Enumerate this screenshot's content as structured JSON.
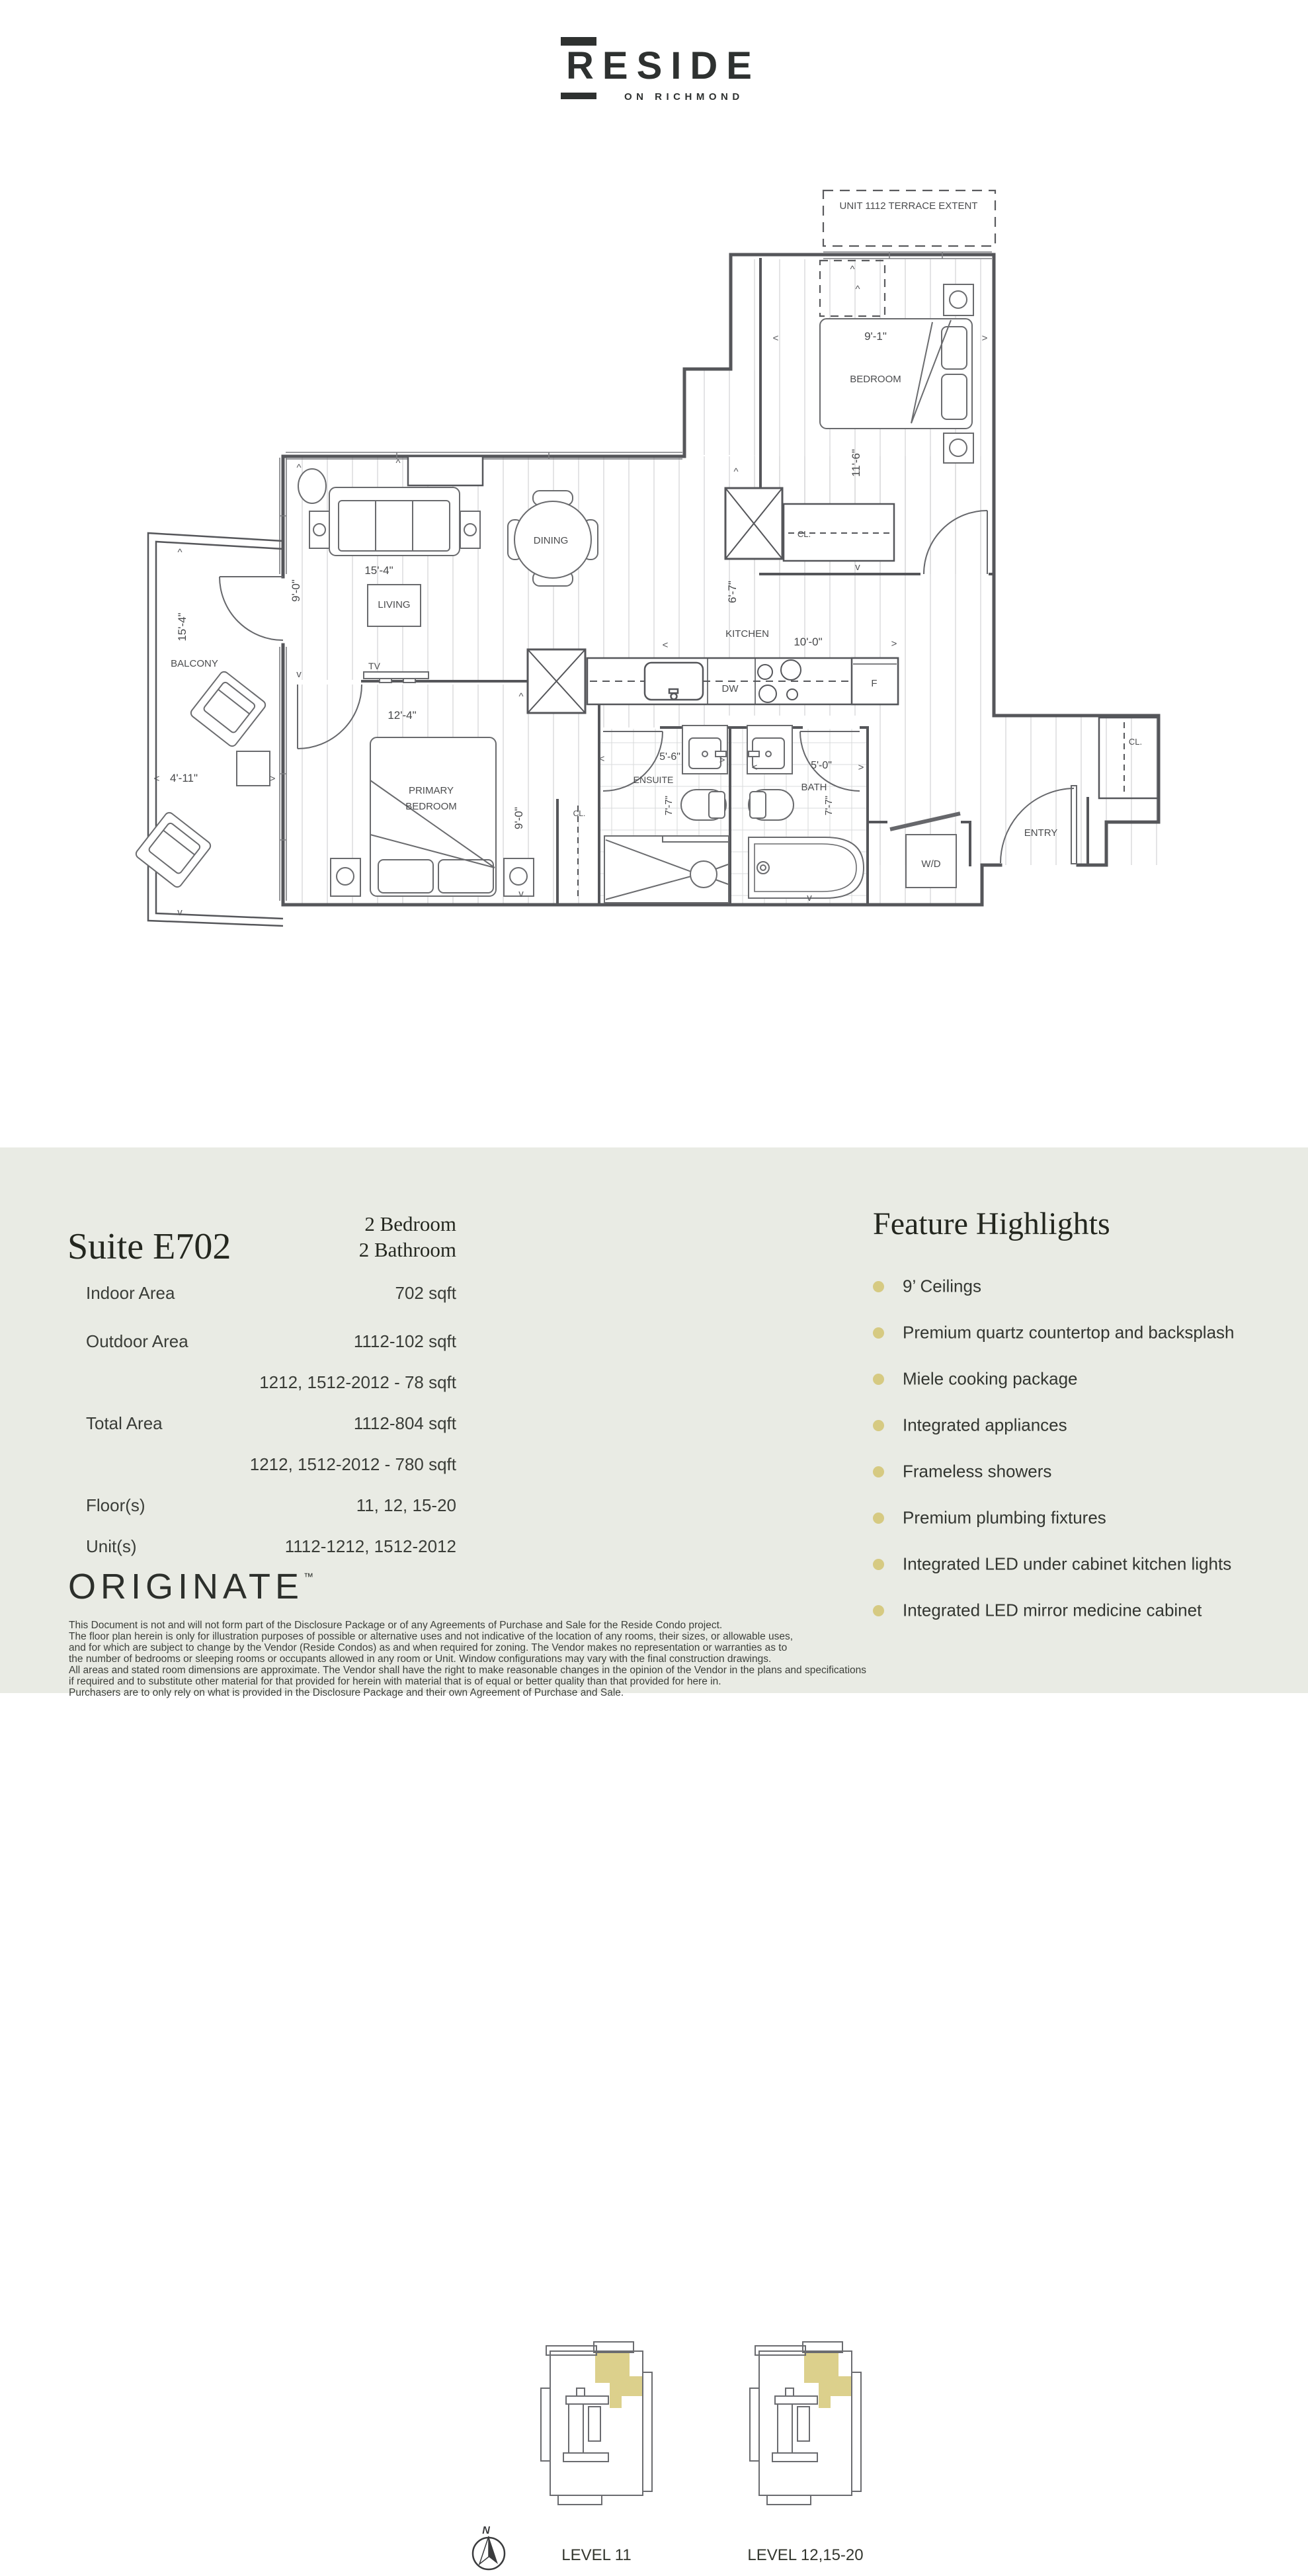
{
  "brand": {
    "name": "RESIDE",
    "tagline": "ON RICHMOND"
  },
  "plan": {
    "terrace_note": "UNIT 1112 TERRACE EXTENT",
    "rooms": {
      "bedroom": "BEDROOM",
      "dining": "DINING",
      "living": "LIVING",
      "kitchen": "KITCHEN",
      "primary_line1": "PRIMARY",
      "primary_line2": "BEDROOM",
      "ensuite": "ENSUITE",
      "bath": "BATH",
      "balcony": "BALCONY",
      "entry": "ENTRY",
      "wd": "W/D",
      "closet": "CL."
    },
    "fixtures": {
      "tv": "TV",
      "dw": "DW",
      "fridge": "F"
    },
    "dims": {
      "bedroom_w": "9'-1\"",
      "bedroom_h": "11'-6\"",
      "living_w": "15'-4\"",
      "living_h": "9'-0\"",
      "dining_to_kitchen": "6'-7\"",
      "kitchen_w": "10'-0\"",
      "primary_w": "12'-4\"",
      "primary_h": "9'-0\"",
      "ensuite_w": "5'-6\"",
      "ensuite_d": "7'-7\"",
      "bath_w": "5'-0\"",
      "bath_d": "7'-7\"",
      "balcony_l": "15'-4\"",
      "balcony_w": "4'-11\""
    }
  },
  "suite": {
    "title": "Suite E702",
    "type_line1": "2 Bedroom",
    "type_line2": "2 Bathroom",
    "specs": [
      {
        "label": "Indoor Area",
        "value": "702 sqft"
      },
      {
        "label": "Outdoor Area",
        "value": "1112-102 sqft"
      },
      {
        "label": "",
        "value": "1212, 1512-2012 - 78 sqft"
      },
      {
        "label": "Total Area",
        "value": "1112-804 sqft"
      },
      {
        "label": "",
        "value": "1212, 1512-2012 - 780 sqft"
      },
      {
        "label": "Floor(s)",
        "value": "11, 12, 15-20"
      },
      {
        "label": "Unit(s)",
        "value": "1112-1212, 1512-2012"
      }
    ]
  },
  "levels": {
    "compass": "N",
    "items": [
      {
        "label": "LEVEL 11"
      },
      {
        "label": "LEVEL 12,15-20"
      }
    ],
    "highlight_color": "#dcd08c"
  },
  "features": {
    "title": "Feature Highlights",
    "bullet_color": "#d6ca82",
    "items": [
      "9’ Ceilings",
      "Premium quartz countertop and backsplash",
      "Miele cooking package",
      "Integrated appliances",
      "Frameless showers",
      "Premium plumbing fixtures",
      "Integrated LED under cabinet kitchen lights",
      "Integrated LED mirror medicine cabinet"
    ]
  },
  "footer": {
    "brand": "ORIGINATE",
    "tm": "™",
    "disclaimer": [
      "This Document is not and will not form part of the Disclosure Package or of any Agreements of Purchase and Sale for the Reside Condo project.",
      "The floor plan herein is only for illustration purposes of possible or alternative uses and not indicative of the location of any rooms, their sizes, or allowable uses,",
      "and for which are subject to change by the Vendor (Reside Condos) as and when required for zoning. The Vendor makes no representation or warranties as to",
      "the number of bedrooms or sleeping rooms or occupants allowed in any room or Unit. Window configurations may vary with the final construction drawings.",
      "All areas and stated room dimensions are approximate. The Vendor shall have the right to make reasonable changes in the opinion of the Vendor in the plans and specifications",
      "if required and to substitute other material for that provided for herein with material that is of equal or better quality than that provided for here in.",
      "Purchasers are to only rely on what is provided in the Disclosure Package and their own Agreement of Purchase and Sale."
    ]
  }
}
